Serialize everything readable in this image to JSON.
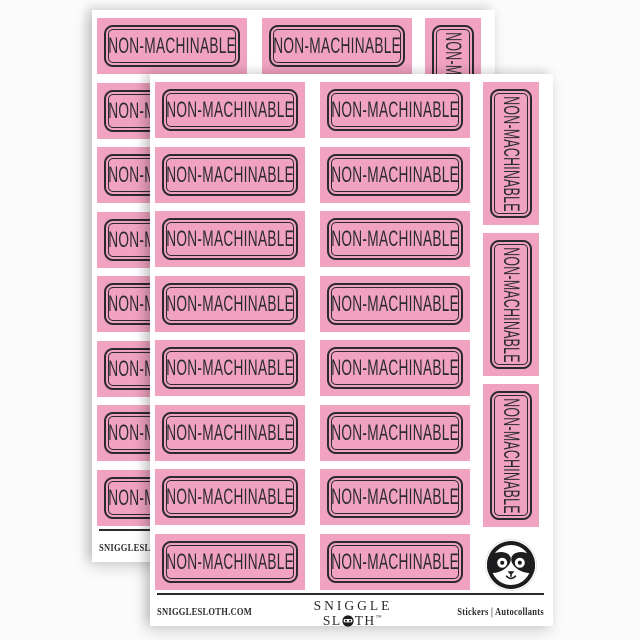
{
  "product": {
    "sticker_label": "NON-MACHINABLE",
    "sheet_count": 2,
    "per_sheet": {
      "horizontal_rows": 8,
      "horizontal_columns": 2,
      "vertical_count": 3
    }
  },
  "footer": {
    "website": "SNIGGLESLOTH.COM",
    "brand_line1": "SNIGGLE",
    "brand_line2_prefix": "SL",
    "brand_line2_suffix": "TH",
    "brand_trademark": "™",
    "right_label": "Stickers  |  Autocollants"
  },
  "colors": {
    "sticker_pink": "#f0a2c0",
    "ink_black": "#2b2b2e",
    "sheet_white": "#ffffff",
    "background": "#fbfbfb"
  }
}
